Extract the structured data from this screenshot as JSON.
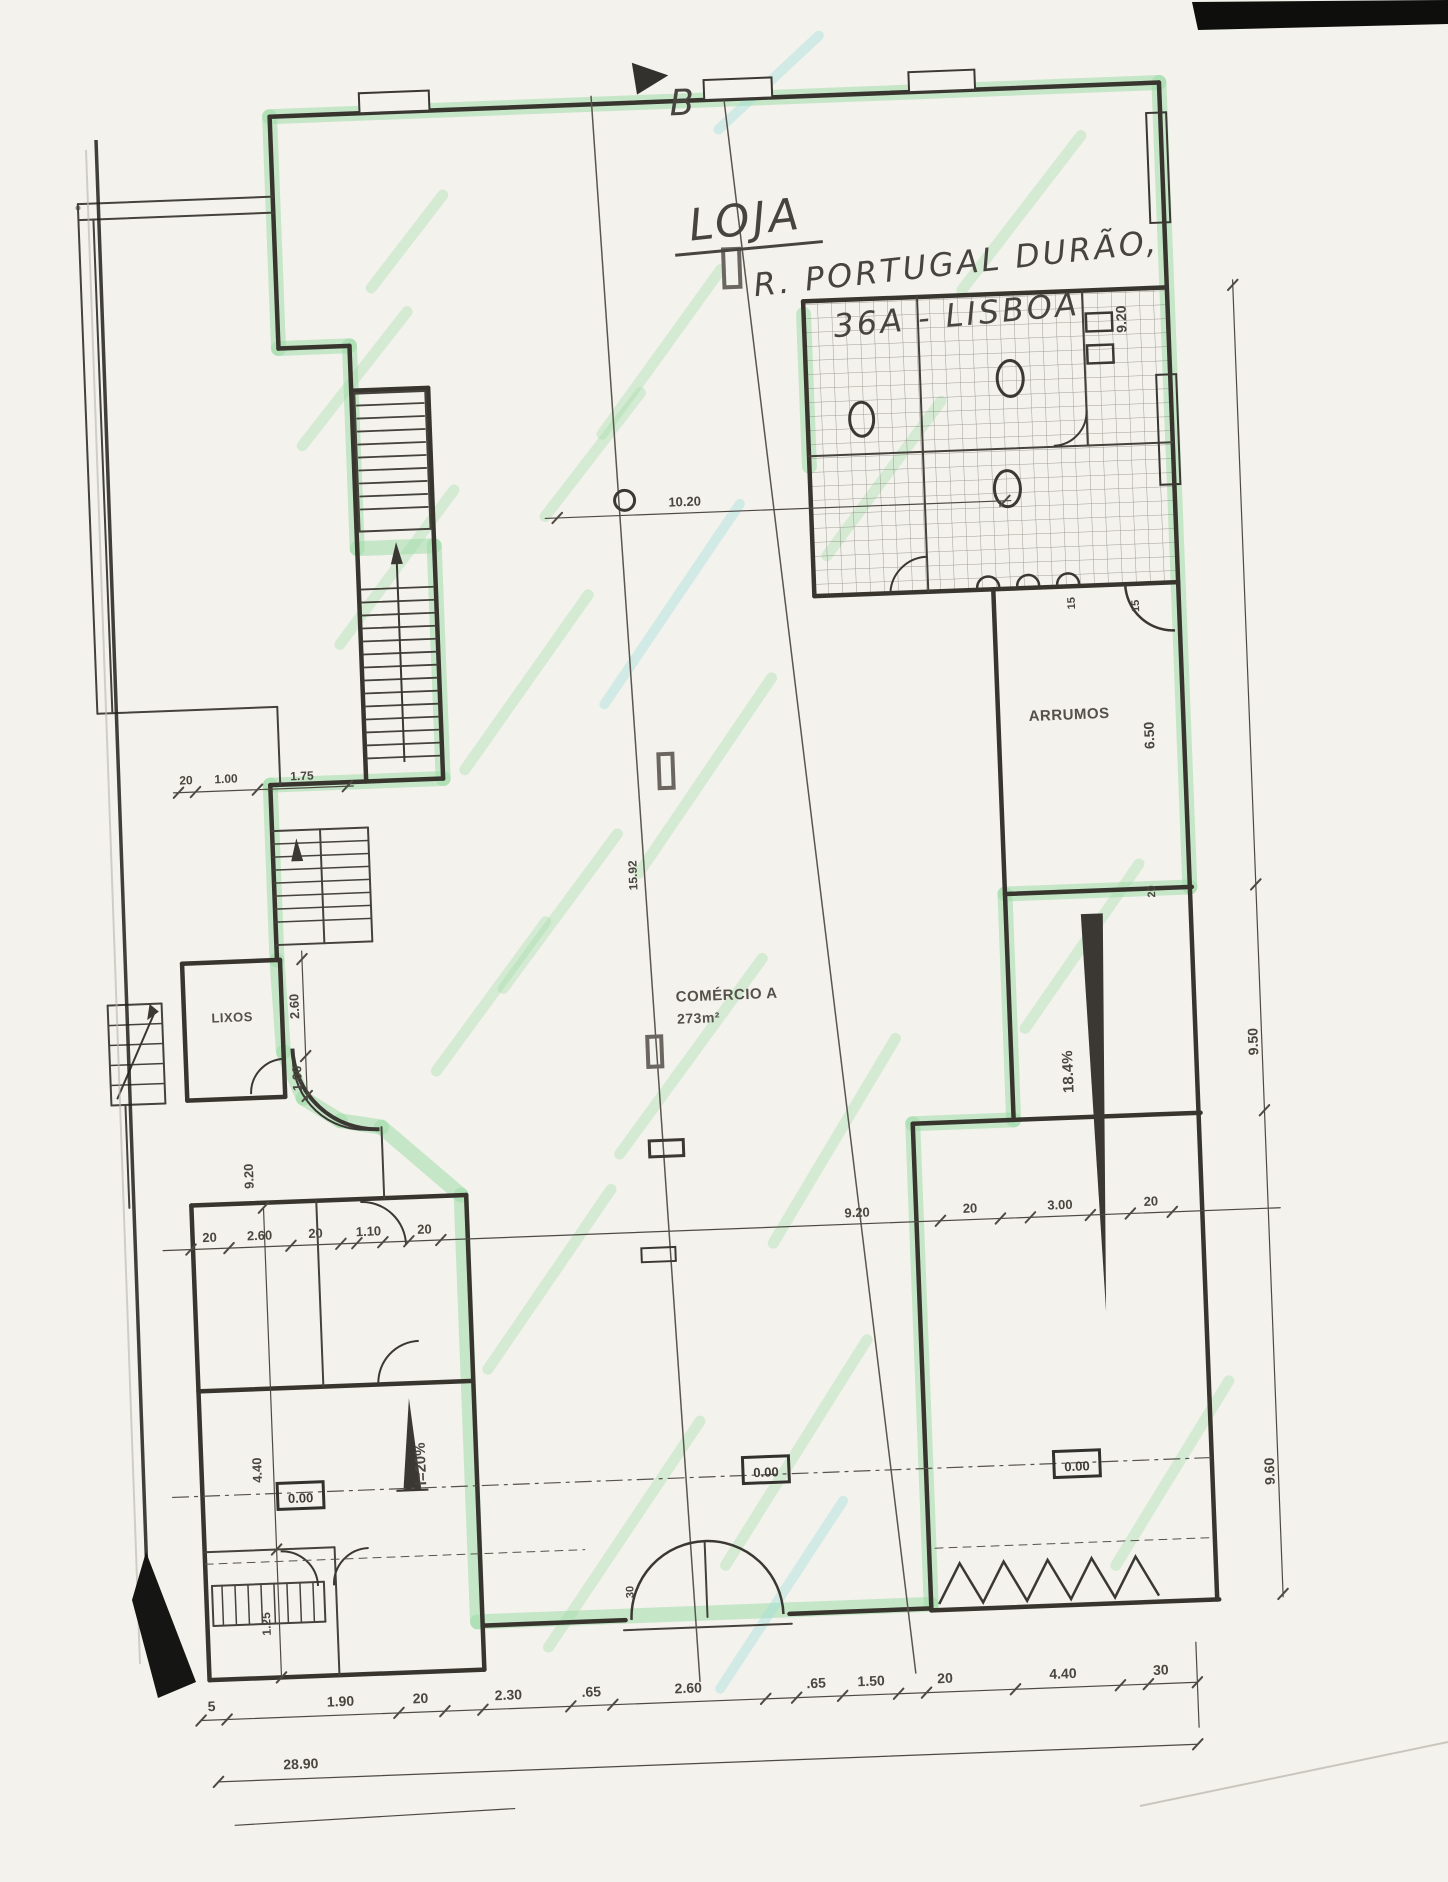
{
  "annotations": {
    "title_line1": "LOJA",
    "title_line2": "R. PORTUGAL DURÃO,",
    "title_line3": "36A - LISBOA",
    "section_marker": "B"
  },
  "rooms": {
    "storage": "ARRUMOS",
    "trash": "LIXOS",
    "commerce": "COMÉRCIO A",
    "commerce_area": "273m²"
  },
  "levels": {
    "left": "0.00",
    "center": "0.00",
    "right": "0.00"
  },
  "slopes": {
    "left_ramp": "i=20%",
    "right_ramp": "18.4%"
  },
  "dimensions": {
    "top_span": "10.20",
    "total_width": "28.90",
    "bottom_row": [
      "5",
      "1.90",
      "20",
      "2.30",
      ".65",
      "2.60",
      ".65",
      "1.50",
      "20",
      "4.40",
      "30"
    ],
    "middle_row": [
      "20",
      "2.60",
      "20",
      "1.10",
      "20",
      "9.20",
      "20",
      "3.00",
      "20"
    ],
    "right_column": [
      "9.20",
      "6.50",
      "9.50",
      "9.60"
    ],
    "left_column": [
      "2.60",
      "1.00",
      "9.20",
      "4.40",
      "1.25"
    ],
    "stair_row": [
      "20",
      "1.00",
      "1.75"
    ],
    "wall_thickness": [
      "15",
      "15",
      "20"
    ],
    "corridor_depth": "15.92",
    "door_width": "30"
  }
}
